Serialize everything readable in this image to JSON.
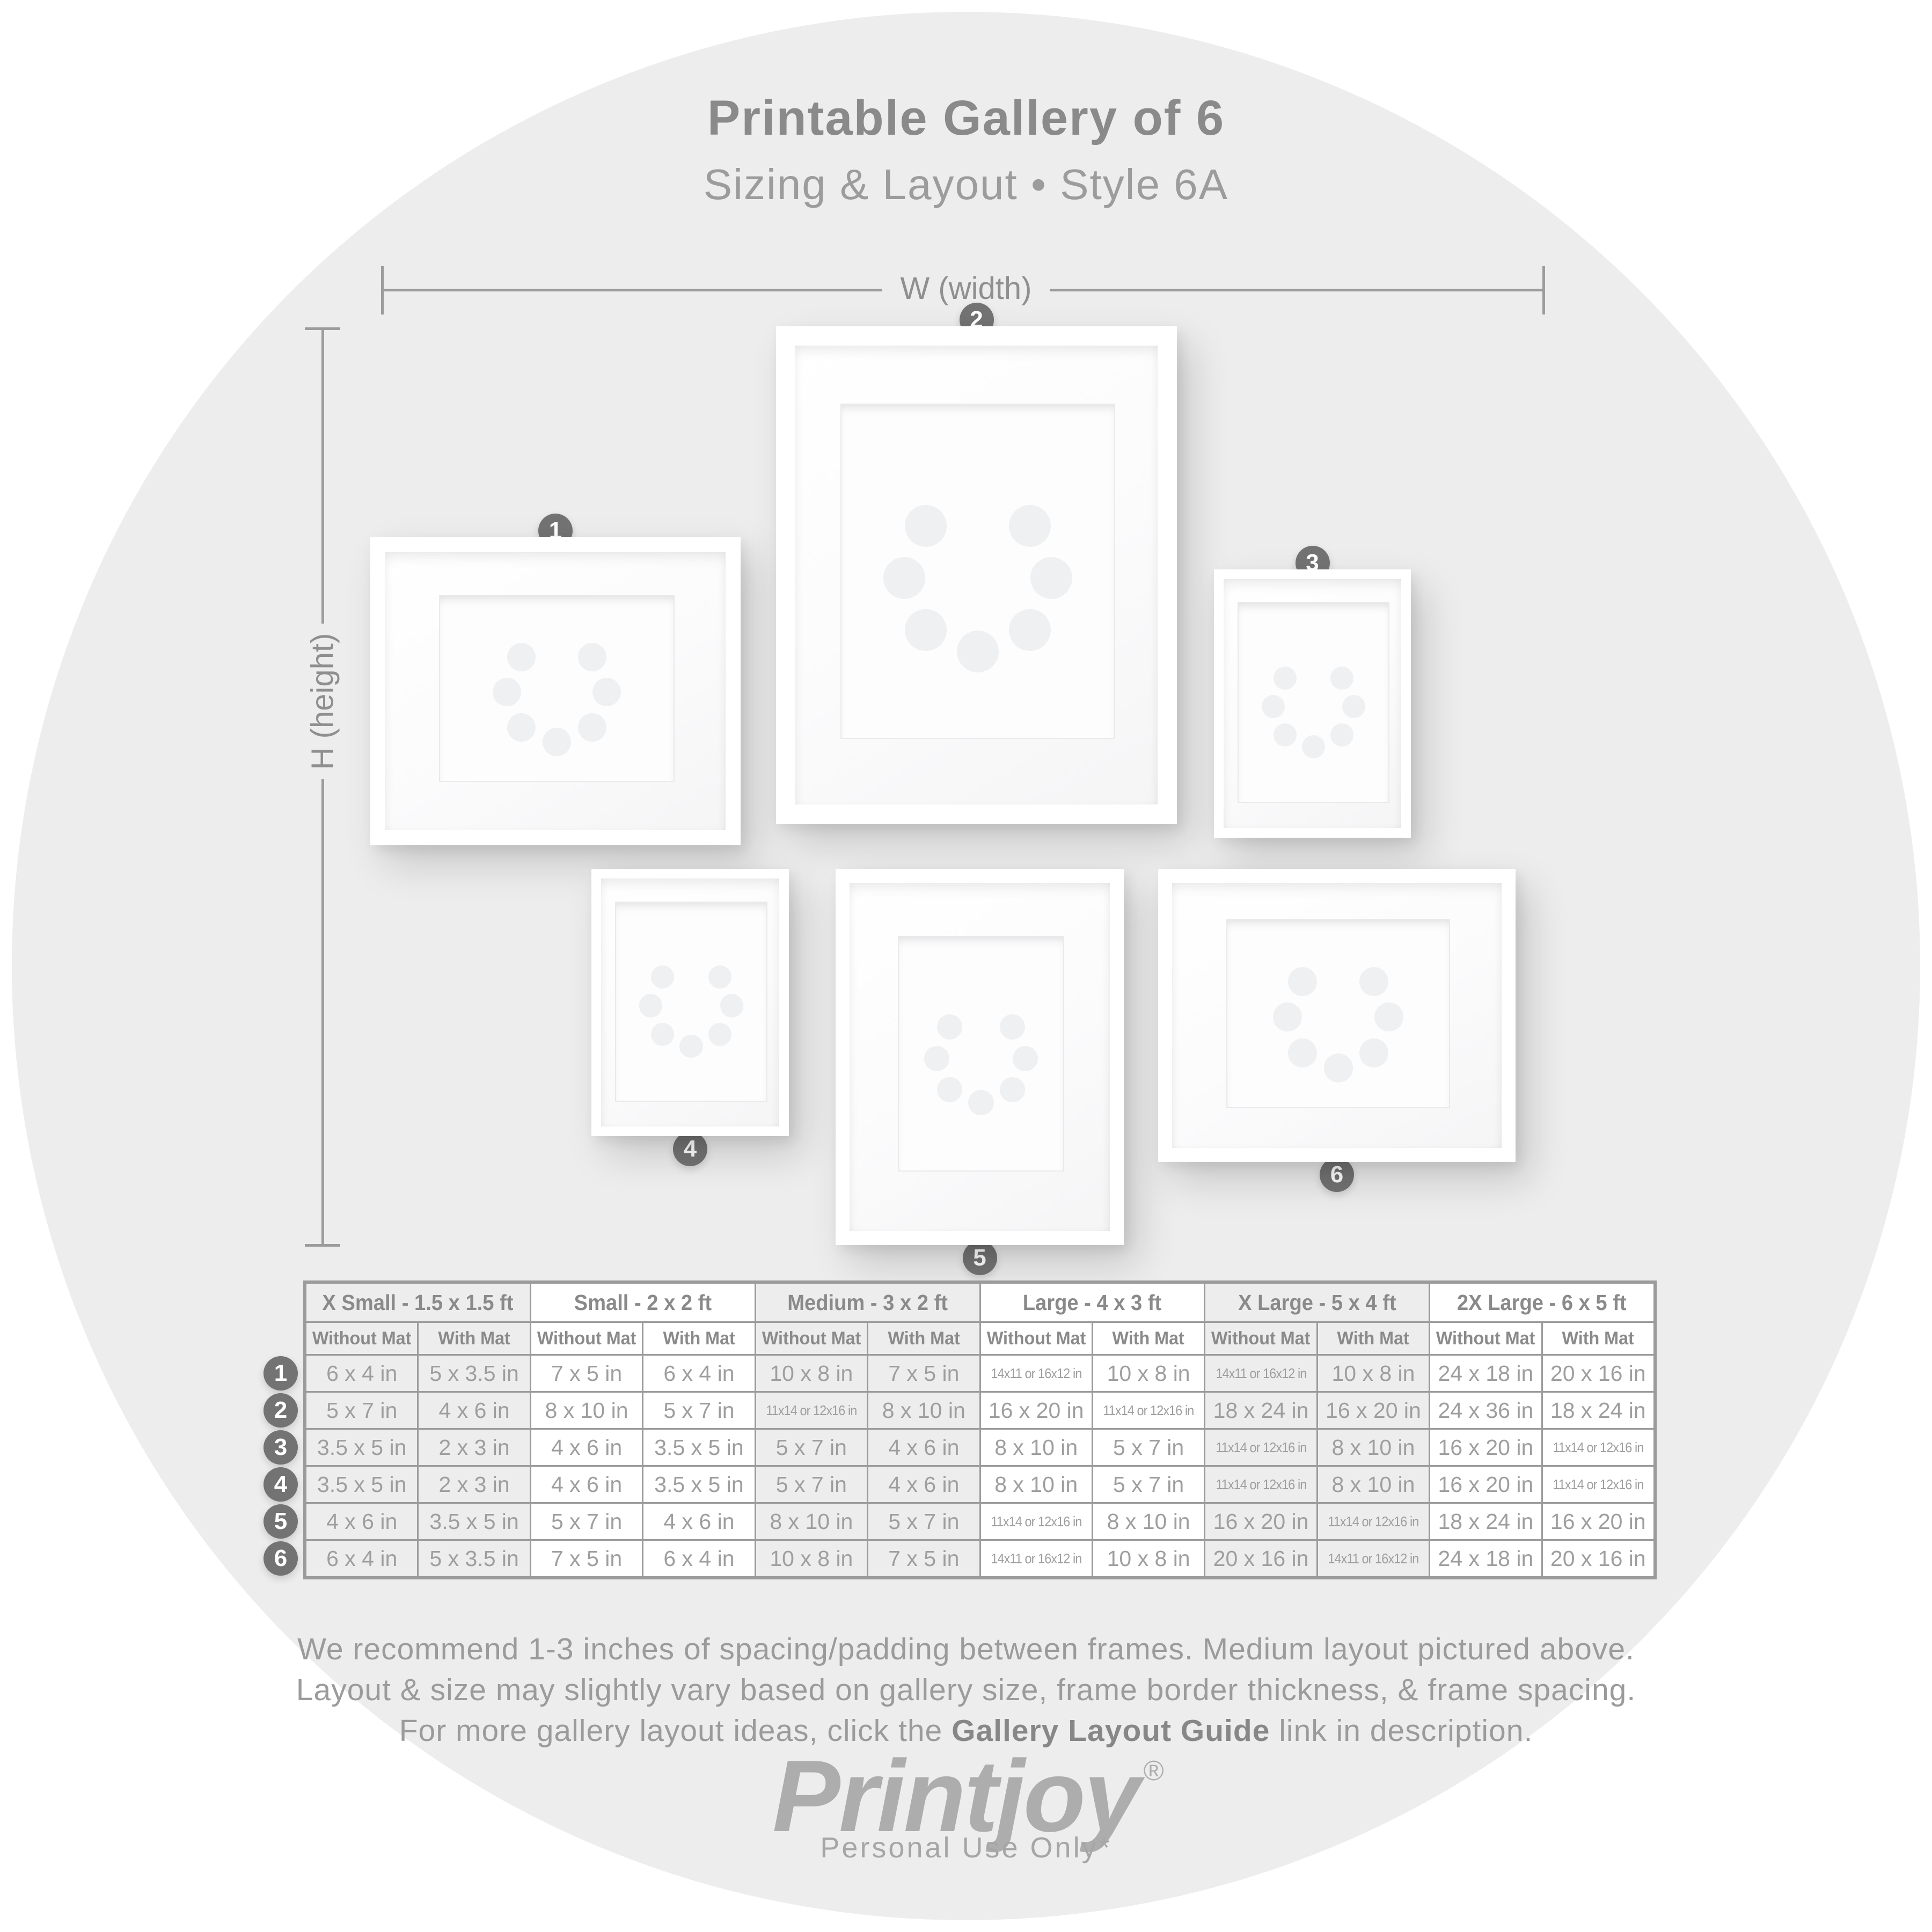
{
  "title": "Printable Gallery of 6",
  "subtitle": "Sizing & Layout • Style 6A",
  "dimension_labels": {
    "width": "W (width)",
    "height": "H (height)"
  },
  "frame_badges": [
    "1",
    "2",
    "3",
    "4",
    "5",
    "6"
  ],
  "table": {
    "groups": [
      "X Small - 1.5 x 1.5 ft",
      "Small - 2 x 2 ft",
      "Medium - 3 x 2 ft",
      "Large - 4 x 3 ft",
      "X Large - 5 x 4 ft",
      "2X Large - 6 x 5 ft"
    ],
    "subheaders": [
      "Without Mat",
      "With Mat"
    ],
    "row_numbers": [
      "1",
      "2",
      "3",
      "4",
      "5",
      "6"
    ],
    "rows": [
      [
        "6 x 4 in",
        "5 x 3.5 in",
        "7 x 5 in",
        "6 x 4 in",
        "10 x 8 in",
        "7 x 5 in",
        "14x11 or 16x12 in",
        "10 x 8 in",
        "14x11 or 16x12 in",
        "10 x 8 in",
        "24 x 18 in",
        "20 x 16 in"
      ],
      [
        "5 x 7 in",
        "4 x 6 in",
        "8 x 10 in",
        "5 x 7 in",
        "11x14 or 12x16 in",
        "8 x 10 in",
        "16 x 20 in",
        "11x14 or 12x16 in",
        "18 x 24 in",
        "16 x 20 in",
        "24 x 36 in",
        "18 x 24 in"
      ],
      [
        "3.5 x 5 in",
        "2 x 3 in",
        "4 x 6 in",
        "3.5 x 5 in",
        "5 x 7 in",
        "4 x 6 in",
        "8 x 10 in",
        "5 x 7 in",
        "11x14 or 12x16 in",
        "8 x 10 in",
        "16 x 20 in",
        "11x14 or 12x16 in"
      ],
      [
        "3.5 x 5 in",
        "2 x 3 in",
        "4 x 6 in",
        "3.5 x 5 in",
        "5 x 7 in",
        "4 x 6 in",
        "8 x 10 in",
        "5 x 7 in",
        "11x14 or 12x16 in",
        "8 x 10 in",
        "16 x 20 in",
        "11x14 or 12x16 in"
      ],
      [
        "4 x 6 in",
        "3.5 x 5 in",
        "5 x 7 in",
        "4 x 6 in",
        "8 x 10 in",
        "5 x 7 in",
        "11x14 or 12x16 in",
        "8 x 10 in",
        "16 x 20 in",
        "11x14 or 12x16 in",
        "18 x 24 in",
        "16 x 20 in"
      ],
      [
        "6 x 4 in",
        "5 x 3.5 in",
        "7 x 5 in",
        "6 x 4 in",
        "10 x 8 in",
        "7 x 5 in",
        "14x11 or 16x12 in",
        "10 x 8 in",
        "20 x 16 in",
        "14x11 or 16x12 in",
        "24 x 18 in",
        "20 x 16 in"
      ]
    ]
  },
  "notes": {
    "line1": "We recommend 1-3 inches of spacing/padding between frames. Medium layout pictured above.",
    "line2": "Layout & size may slightly vary based on gallery size, frame border thickness, & frame spacing.",
    "line3_prefix": "For more gallery layout ideas, click the ",
    "line3_bold": "Gallery Layout Guide",
    "line3_suffix": " link in description."
  },
  "brand": {
    "name": "Printjoy",
    "registered": "®",
    "tagline": "Personal Use Only*"
  },
  "colors": {
    "background": "#ffffff",
    "circle": "#ededed",
    "heading_gray": "#8a8a8a",
    "cell_text_gray": "#9e9e9e",
    "table_border": "#9b9b9b",
    "badge_gray": "#737373",
    "logo_gray": "#adadad"
  }
}
